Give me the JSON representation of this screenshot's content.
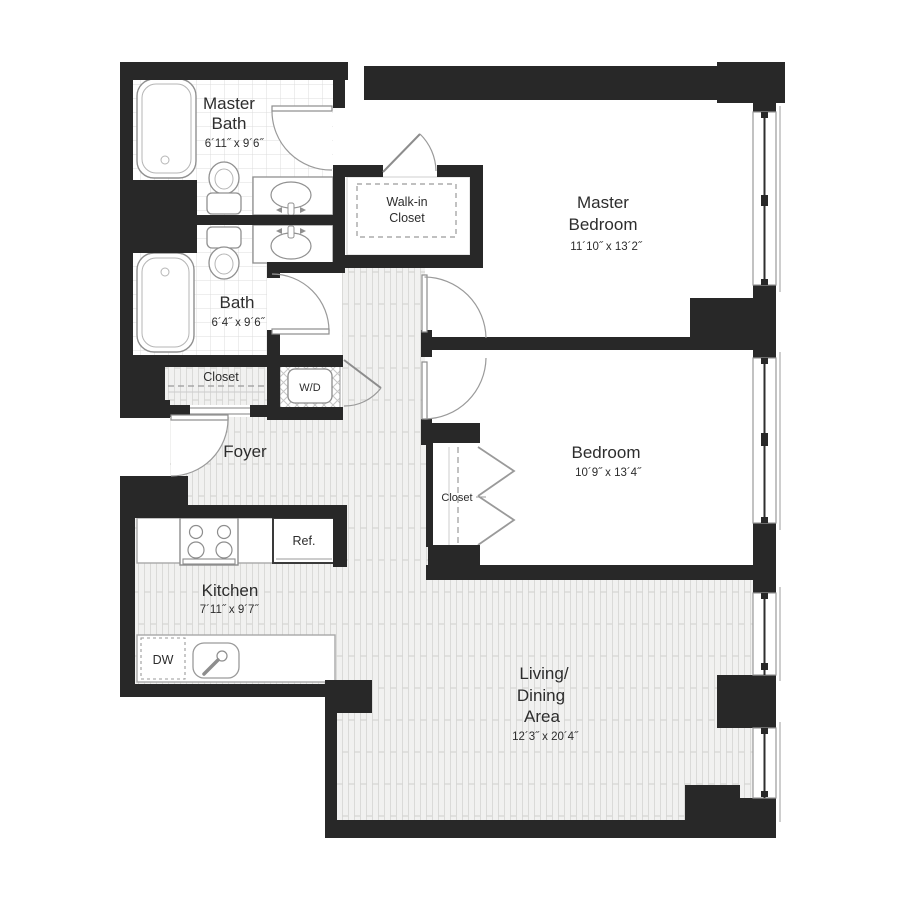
{
  "plan": {
    "rooms": {
      "master_bath": {
        "name_line1": "Master",
        "name_line2": "Bath",
        "dims": "6´11˝ x 9´6˝"
      },
      "bath": {
        "name": "Bath",
        "dims": "6´4˝ x 9´6˝"
      },
      "walk_in_closet": {
        "name_line1": "Walk-in",
        "name_line2": "Closet"
      },
      "master_bedroom": {
        "name_line1": "Master",
        "name_line2": "Bedroom",
        "dims": "11´10˝ x 13´2˝"
      },
      "bedroom": {
        "name": "Bedroom",
        "dims": "10´9˝ x 13´4˝"
      },
      "bedroom_closet": {
        "name": "Closet"
      },
      "hall_closet": {
        "name": "Closet"
      },
      "laundry": {
        "name": "W/D"
      },
      "foyer": {
        "name": "Foyer"
      },
      "kitchen": {
        "name": "Kitchen",
        "dims": "7´11˝ x 9´7˝"
      },
      "living_dining": {
        "name_line1": "Living/",
        "name_line2": "Dining",
        "name_line3": "Area",
        "dims": "12´3˝ x 20´4˝"
      }
    },
    "appliances": {
      "refrigerator": "Ref.",
      "dishwasher": "DW"
    },
    "colors": {
      "wall": "#282828",
      "wood_floor": "#f1f1f0",
      "fixture_stroke": "#909090"
    }
  }
}
